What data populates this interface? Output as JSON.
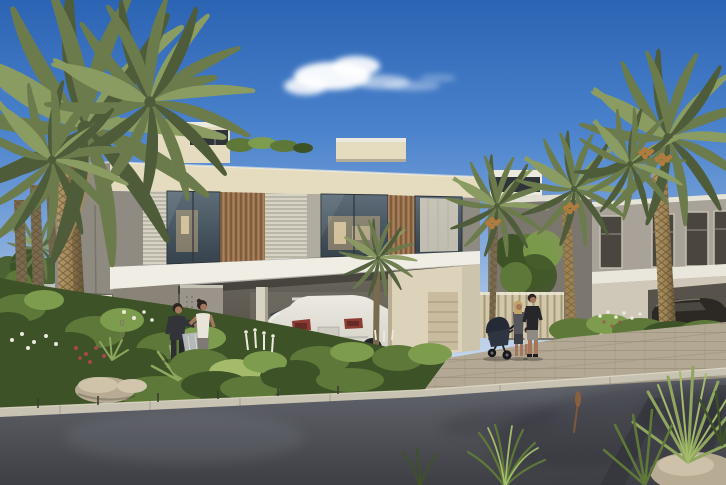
{
  "scene": {
    "description": "Sunny architectural rendering of modern two-storey townhouses with palm trees, a landscaped desert garden, a white SUV parked in a carport, a couple chatting by the entrance, a family with a stroller on the sidewalk, and an asphalt road in the foreground under a blue sky with one white cloud.",
    "gatepost_number": "00",
    "colors": {
      "sky_top": "#2c64b4",
      "sky_upper": "#4a82cc",
      "sky_mid": "#7fa7da",
      "sky_low": "#b7cde8",
      "sky_horizon": "#d6e3f2",
      "cloud": "#ffffff",
      "villa_cream": "#e5dcc0",
      "villa_cream_light": "#f0ead5",
      "villa_grey_wall": "#8e8a80",
      "villa_grey_dark": "#6e6a61",
      "fascia_white": "#efede4",
      "box_white": "#eceadf",
      "slot_dark": "#2f343a",
      "wood_slat": "#9c7450",
      "wood_slat_dark": "#6b4a2f",
      "louvre": "#d6d2c4",
      "concrete_col": "#b1aba0",
      "glass_top": "#5d6d79",
      "glass_bottom": "#36424c",
      "interior_warm": "#c7ad80",
      "interior_bright": "#e6d2a8",
      "right_upper": "#a8a299",
      "right_lower": "#cfc8b9",
      "right_west": "#7b766e",
      "right_beam": "#e9e6dc",
      "window_dark": "#4a463f",
      "window_frame": "#c5bfb2",
      "carport_dark": "#4e4a43",
      "carport_mid": "#6b675e",
      "entrance_beige": "#ddd3ba",
      "door_tan": "#c8bb9e",
      "gate_rib": "#d3c7a9",
      "pillar_face": "#e0d6bb",
      "number": "#7d7260",
      "palm_dark": "#4e5c39",
      "palm_mid": "#6b7b4c",
      "palm_light": "#8b9c62",
      "date_orange": "#b07c3e",
      "trunk_light": "#b49a6a",
      "trunk_mid": "#9c8153",
      "trunk_dark": "#5e4f38",
      "trunk_slim": "#7a6a4e",
      "green_dark": "#3d5226",
      "green_mid": "#5d7838",
      "green_light": "#7e9c4e",
      "green_sun": "#a3bb6a",
      "flower_white": "#eceadf",
      "flower_red": "#a84848",
      "agave": "#8fa65e",
      "rock": "#b7ab93",
      "rock_light": "#d1c6ad",
      "pavement": "#b3a893",
      "curb": "#c8c2b2",
      "road_light": "#64666e",
      "road_dark": "#3e3f44",
      "tree_green": "#4a6234",
      "suv_body": "#eceae2",
      "suv_shade": "#d2cfc6",
      "suv_window": "#394048",
      "taillight": "#8c3b33",
      "plate": "#cfccc3",
      "wheel_dark": "#26262a",
      "wheel_hub": "#55565c",
      "car_dark": "#2c2824",
      "car_glint": "#8a8478",
      "skin": "#a3775c",
      "hair_dark": "#2b2420",
      "hair_blonde": "#c4a368",
      "shirt_dark": "#33343a",
      "tank_white": "#e8e4da",
      "pants_grey": "#7d7974",
      "shorts_grey": "#8f8b84",
      "bag_grey": "#b9bdc2",
      "stroller": "#2e3440"
    }
  }
}
